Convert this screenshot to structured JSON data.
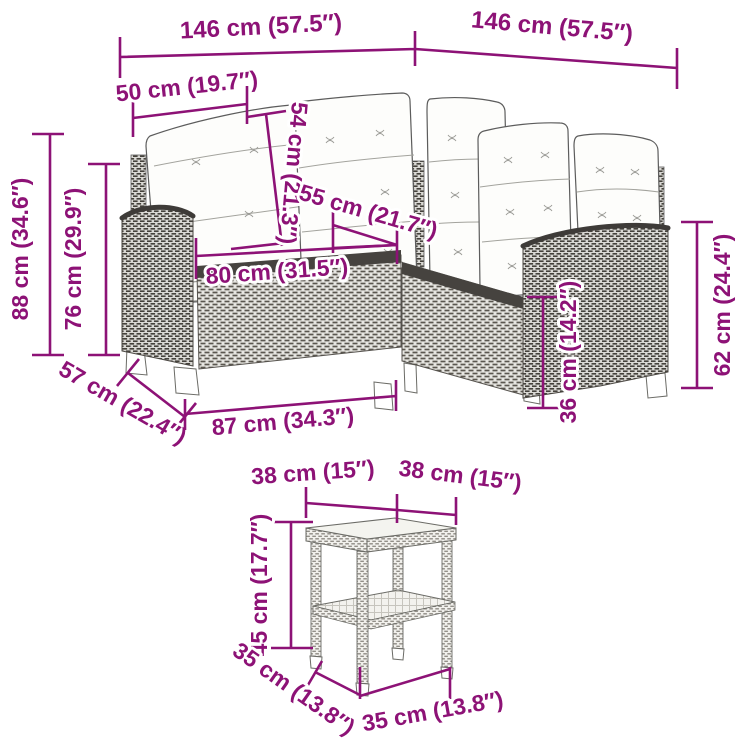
{
  "page": {
    "background": "#ffffff"
  },
  "colors": {
    "dimension_annotation": "#8D1276",
    "line_art_stroke": "#5c5c5c"
  },
  "diagram": {
    "description": "L-shaped poly rattan garden sofa with cushions and matching side table, annotated with product dimensions",
    "sofa": {
      "dims": {
        "back_width_left": "146 cm (57.5″)",
        "back_width_right": "146 cm (57.5″)",
        "back_cushion_width": "50 cm (19.7″)",
        "backrest_height": "54 cm (21.3″)",
        "seat_depth": "55 cm (21.7″)",
        "seat_width": "80 cm (31.5″)",
        "overall_height": "88 cm (34.6″)",
        "back_height": "76 cm (29.9″)",
        "side_depth": "57 cm (22.4″)",
        "front_width": "87 cm (34.3″)",
        "seat_height": "36 cm (14.2″)",
        "armrest_height": "62 cm (24.4″)"
      }
    },
    "table": {
      "dims": {
        "top_width_left": "38 cm (15″)",
        "top_width_right": "38 cm (15″)",
        "height": "45 cm (17.7″)",
        "base_depth": "35 cm (13.8″)",
        "base_width": "35 cm (13.8″)"
      }
    }
  }
}
